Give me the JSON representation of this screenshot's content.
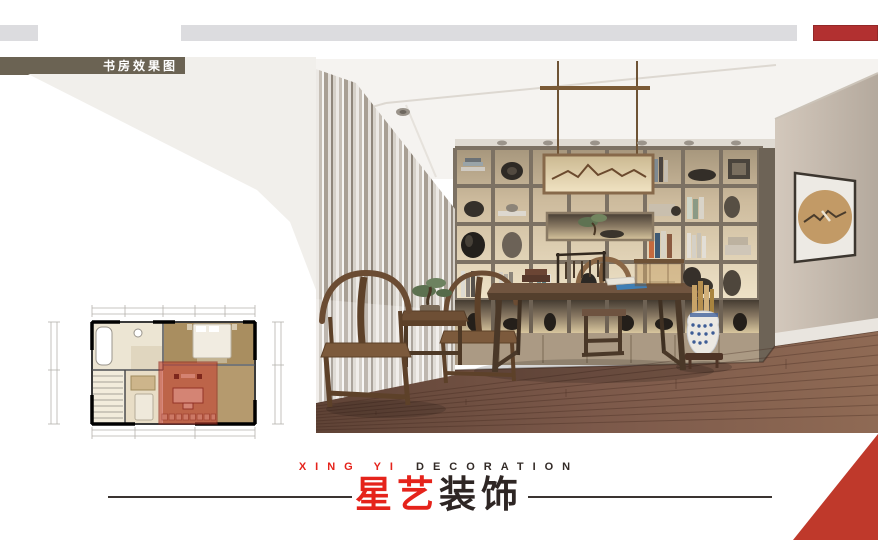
{
  "badge": {
    "label": "书房效果图"
  },
  "brand": {
    "english_red": "XING YI",
    "english_dark": "DECORATION",
    "chinese_red": "星艺",
    "chinese_dark": "装饰"
  },
  "colors": {
    "accent_red": "#e5231b",
    "dark_text": "#2e2624",
    "badge_bg": "#6b6353",
    "top_bar_gray": "#dcdcdf",
    "top_bar_red": "#b23030",
    "corner_red": "#bf392b",
    "plan_highlight": "rgba(194,68,52,0.62)"
  }
}
